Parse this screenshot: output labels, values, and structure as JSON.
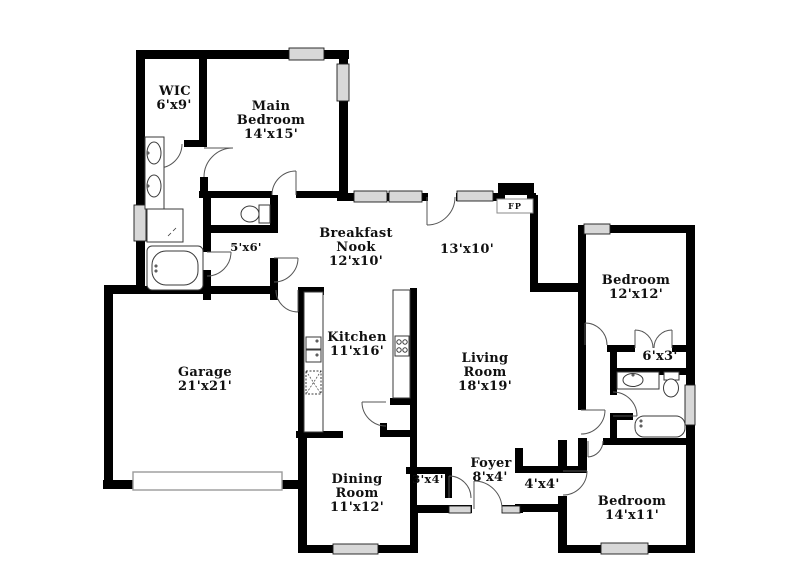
{
  "plan_title": "Single-story house floor plan",
  "colors": {
    "wall": "#000000",
    "floor": "#ffffff",
    "window": "#d8d8d8",
    "door_arc": "#555555",
    "fixture_outline": "#3a3a3a",
    "label_text": "#101010"
  },
  "rooms": {
    "wic": {
      "name": "WIC",
      "dims": "6'x9'"
    },
    "main_bedroom": {
      "name_line1": "Main",
      "name_line2": "Bedroom",
      "dims": "14'x15'"
    },
    "breakfast_nook": {
      "name_line1": "Breakfast",
      "name_line2": "Nook",
      "dims": "12'x10'"
    },
    "flex_space": {
      "dims": "13'x10'"
    },
    "bedroom_2": {
      "name": "Bedroom",
      "dims": "12'x12'"
    },
    "kitchen": {
      "name": "Kitchen",
      "dims": "11'x16'"
    },
    "living_room": {
      "name_line1": "Living",
      "name_line2": "Room",
      "dims": "18'x19'"
    },
    "garage": {
      "name": "Garage",
      "dims": "21'x21'"
    },
    "closet_5x6": {
      "dims": "5'x6'"
    },
    "closet_6x3": {
      "dims": "6'x3'"
    },
    "dining_room": {
      "name_line1": "Dining",
      "name_line2": "Room",
      "dims": "11'x12'"
    },
    "foyer": {
      "name": "Foyer",
      "dims": "8'x4'"
    },
    "closet_3x4": {
      "dims": "3'x4'"
    },
    "closet_4x4": {
      "dims": "4'x4'"
    },
    "bedroom_3": {
      "name": "Bedroom",
      "dims": "14'x11'"
    },
    "fireplace": {
      "abbr": "FP"
    }
  }
}
